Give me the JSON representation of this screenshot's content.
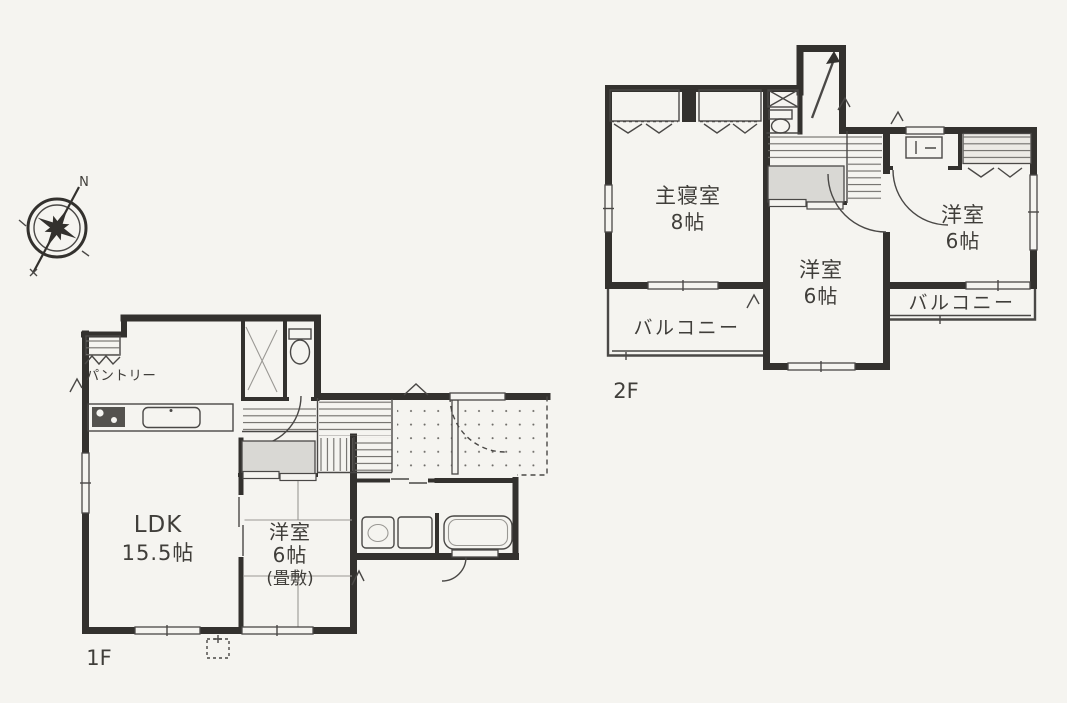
{
  "colors": {
    "paper": "#f5f4f0",
    "ink": "#403e3a",
    "wall": "#33312e",
    "line": "#4a4846",
    "hatch": "#6e6c68",
    "closet": "#d9d8d4",
    "closet_light": "#eceae5"
  },
  "compass": {
    "north": "N"
  },
  "floor2": {
    "label": "2F",
    "master_name": "主寝室",
    "master_size": "8帖",
    "room_mid_name": "洋室",
    "room_mid_size": "6帖",
    "room_right_name": "洋室",
    "room_right_size": "6帖",
    "balcony_left": "バルコニー",
    "balcony_right": "バルコニー"
  },
  "floor1": {
    "label": "1F",
    "ldk_name": "LDK",
    "ldk_size": "15.5帖",
    "tatami_name": "洋室",
    "tatami_size": "6帖",
    "tatami_note": "(畳敷)",
    "pantry": "パントリー"
  }
}
